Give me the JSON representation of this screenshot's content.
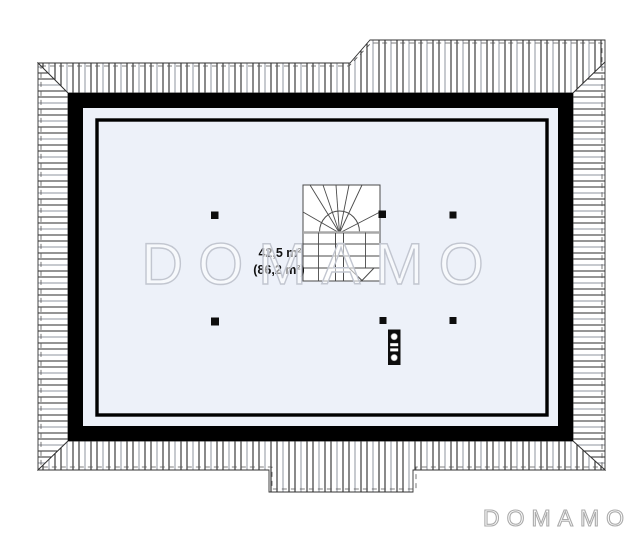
{
  "canvas": {
    "width": 640,
    "height": 534
  },
  "plan": {
    "type": "attic-floor-plan",
    "area_label": {
      "primary": "42,5 m²",
      "secondary": "(86,2 m²)"
    },
    "watermark": {
      "center_text": "DOMAMO",
      "corner_text": "DOMAMO"
    },
    "colors": {
      "floor": "#edf1f9",
      "wall": "#000000",
      "stair_fill": "#ffffff",
      "hatch_dark": "#2b2b2b",
      "hatch_light": "#a9adb5",
      "drawing_line": "#4a4a4a",
      "watermark_center_stroke": "#c2c6d0",
      "watermark_center_fill": "rgba(255,255,255,0.55)",
      "watermark_corner_stroke": "#ababab"
    }
  }
}
